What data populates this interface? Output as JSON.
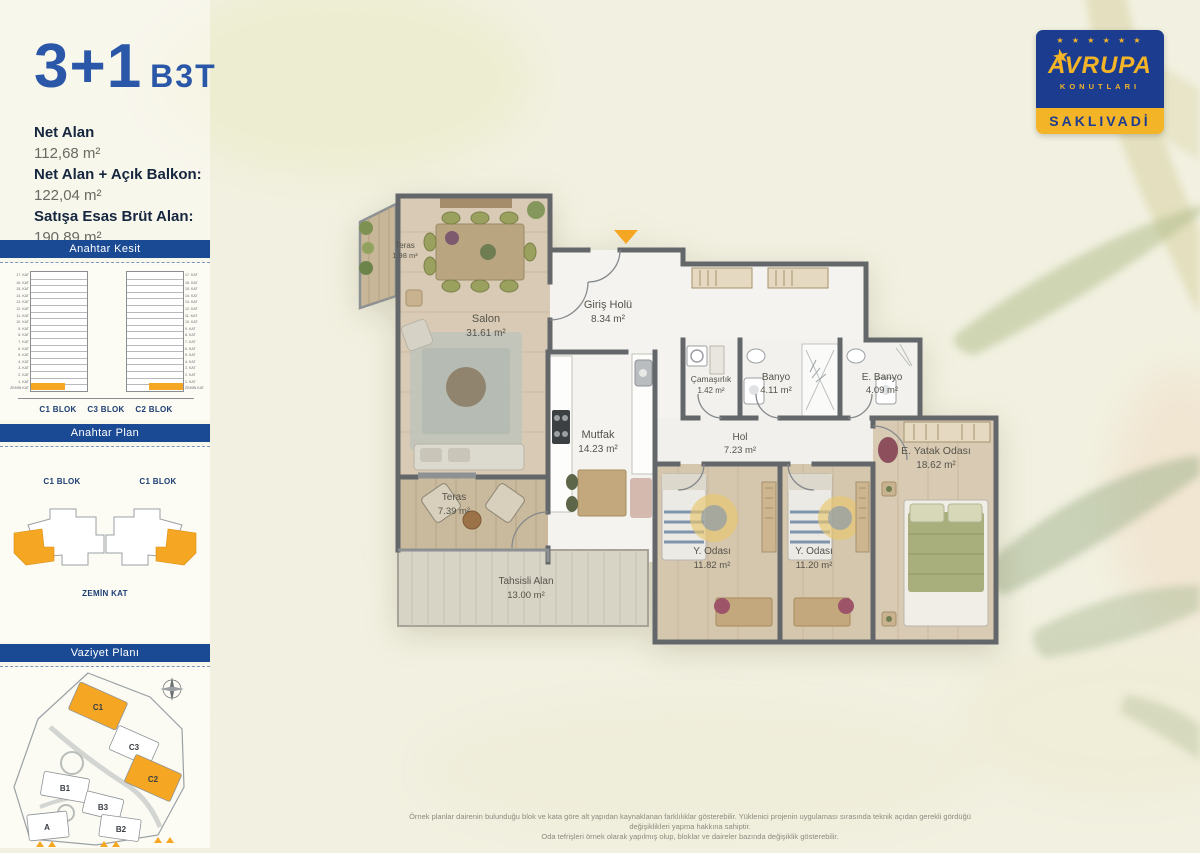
{
  "header": {
    "title_rooms": "3+1",
    "title_code": "B3T"
  },
  "areas": {
    "net_alan_label": "Net Alan",
    "net_alan_value": "112,68 m²",
    "balkon_label": "Net Alan + Açık Balkon:",
    "balkon_value": "122,04 m²",
    "brut_label": "Satışa Esas Brüt Alan:",
    "brut_value": "190,89 m²"
  },
  "anahtar_kesit": {
    "title": "Anahtar Kesit",
    "floors": [
      "17. KAT",
      "16. KAT",
      "15. KAT",
      "14. KAT",
      "13. KAT",
      "12. KAT",
      "11. KAT",
      "10. KAT",
      "9. KAT",
      "8. KAT",
      "7. KAT",
      "6. KAT",
      "5. KAT",
      "4. KAT",
      "3. KAT",
      "2. KAT",
      "1. KAT",
      "ZEMİN KAT"
    ],
    "blocks": [
      "C1 BLOK",
      "C3 BLOK",
      "C2 BLOK"
    ]
  },
  "anahtar_plan": {
    "title": "Anahtar Plan",
    "left_block": "C1 BLOK",
    "right_block": "C1 BLOK",
    "caption": "ZEMİN KAT"
  },
  "vaziyet": {
    "title": "Vaziyet Planı",
    "labels": {
      "c1": "C1",
      "c3": "C3",
      "c2": "C2",
      "b1": "B1",
      "b3": "B3",
      "b2": "B2",
      "a": "A"
    },
    "highlight_color": "#f5a623"
  },
  "logo": {
    "stars": "★ ★ ★ ★ ★ ★",
    "brand": "AVRUPA",
    "big_star": "★",
    "sub": "KONUTLARI",
    "project": "SAKLIVADİ"
  },
  "plan": {
    "rooms": {
      "teras_kucuk": {
        "name": "Teras",
        "area": "1.98 m²"
      },
      "salon": {
        "name": "Salon",
        "area": "31.61 m²"
      },
      "giris_holu": {
        "name": "Giriş Holü",
        "area": "8.34 m²"
      },
      "mutfak": {
        "name": "Mutfak",
        "area": "14.23 m²"
      },
      "camasirlik": {
        "name": "Çamaşırlık",
        "area": "1.42 m²"
      },
      "banyo": {
        "name": "Banyo",
        "area": "4.11 m²"
      },
      "e_banyo": {
        "name": "E. Banyo",
        "area": "4.09 m²"
      },
      "hol": {
        "name": "Hol",
        "area": "7.23 m²"
      },
      "e_yatak": {
        "name": "E. Yatak Odası",
        "area": "18.62 m²"
      },
      "y_odasi_1": {
        "name": "Y. Odası",
        "area": "11.82 m²"
      },
      "y_odasi_2": {
        "name": "Y. Odası",
        "area": "11.20 m²"
      },
      "teras_buyuk": {
        "name": "Teras",
        "area": "7.39 m²"
      },
      "tahsisli": {
        "name": "Tahsisli Alan",
        "area": "13.00 m²"
      }
    }
  },
  "footer": {
    "line1": "Örnek planlar dairenin bulunduğu blok ve kata göre alt yapıdan kaynaklanan farklılıklar gösterebilir. Yüklenici projenin uygulaması sırasında teknik açıdan gerekli gördüğü değişiklikleri yapma hakkına sahiptir.",
    "line2": "Oda tefrişleri örnek olarak yapılmış olup, bloklar ve daireler bazında değişiklik gösterebilir."
  },
  "colors": {
    "accent_blue": "#1a4a94",
    "title_blue": "#2b57a8",
    "highlight_orange": "#f5a623",
    "wall_gray": "#63676a",
    "background_cream": "#f2f1e1"
  }
}
